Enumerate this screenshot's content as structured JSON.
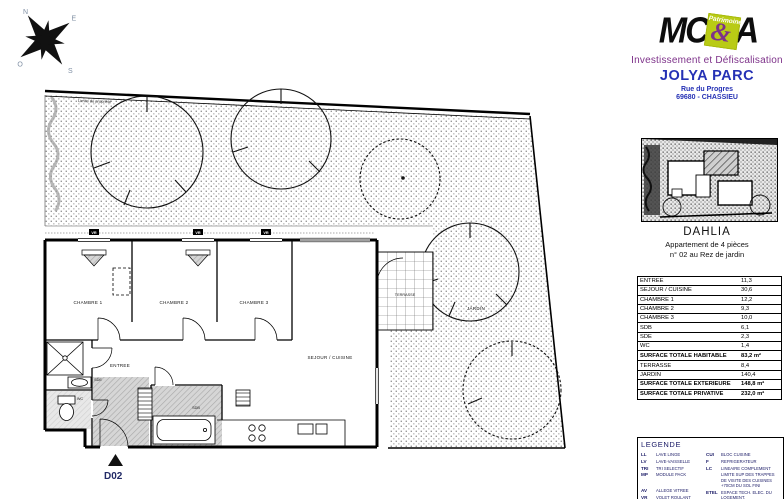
{
  "branding": {
    "logo": {
      "mc": "MC",
      "amp": "&",
      "a": "A",
      "badge": "Patrimoine"
    },
    "tagline": "Investissement et Défiscalisation",
    "project": "JOLYA PARC",
    "address1": "Rue du Progres",
    "address2": "69680 - CHASSIEU"
  },
  "apartment": {
    "name": "DAHLIA",
    "type": "Appartement de 4 pièces",
    "floor": "n° 02 au Rez de jardin"
  },
  "areas": {
    "rows": [
      {
        "label": "ENTREE",
        "value": "11,3"
      },
      {
        "label": "SEJOUR / CUISINE",
        "value": "30,6"
      },
      {
        "label": "CHAMBRE 1",
        "value": "12,2"
      },
      {
        "label": "CHAMBRE 2",
        "value": "9,3"
      },
      {
        "label": "CHAMBRE 3",
        "value": "10,0"
      },
      {
        "label": "SDB",
        "value": "6,1"
      },
      {
        "label": "SDE",
        "value": "2,3"
      },
      {
        "label": "WC",
        "value": "1,4"
      },
      {
        "label": "SURFACE TOTALE HABITABLE",
        "value": "83,2 m²"
      },
      {
        "label": "TERRASSE",
        "value": "8,4"
      },
      {
        "label": "JARDIN",
        "value": "140,4"
      },
      {
        "label": "SURFACE TOTALE EXTERIEURE",
        "value": "148,8 m²"
      },
      {
        "label": "SURFACE TOTALE PRIVATIVE",
        "value": "232,0 m²"
      }
    ]
  },
  "legend": {
    "title": "LEGENDE",
    "left": [
      {
        "abbr": "LL",
        "text": "LAVE LINGE"
      },
      {
        "abbr": "LV",
        "text": "LAVE-VAISSELLE"
      },
      {
        "abbr": "TRI",
        "text": "TRI SELECTIF"
      },
      {
        "abbr": "MP",
        "text": "MODULE PACK"
      },
      {
        "abbr": "AV",
        "text": "ALLEGE VITREE"
      },
      {
        "abbr": "VR",
        "text": "VOLET ROULANT"
      }
    ],
    "right": [
      {
        "abbr": "CUI",
        "text": "BLOC CUISINE"
      },
      {
        "abbr": "F",
        "text": "REFRIGERATEUR"
      },
      {
        "abbr": "LC",
        "text": "LINEAIRE COMPLEMENT"
      },
      {
        "abbr": "",
        "text": "LIMITE SUP DES TRAPPES DE VISITE DES CUISINES +70CM DU SOL FINI"
      },
      {
        "abbr": "ETEL",
        "text": "ESPACE TECH. ELEC. DU LOGEMENT."
      },
      {
        "abbr": "GC",
        "text": "GARDE CORPS"
      }
    ]
  },
  "plan": {
    "unit": "D02",
    "window_tag": "VR",
    "boundary_note": "Limite de propriété",
    "labels": {
      "ch1": "CHAMBRE 1",
      "ch2": "CHAMBRE 2",
      "ch3": "CHAMBRE 3",
      "sejour": "SEJOUR / CUISINE",
      "entree": "ENTREE",
      "sde": "SDE",
      "wc": "WC",
      "sdb": "SDB",
      "terrasse": "TERRASSE",
      "jardin": "JARDIN"
    },
    "compass": {
      "n": "N",
      "e": "E",
      "s": "S",
      "o": "O"
    }
  },
  "colors": {
    "brand_green": "#b9cb15",
    "brand_purple": "#7d3189",
    "brand_blue": "#2531b5",
    "legend_navy": "#1a1a66"
  }
}
